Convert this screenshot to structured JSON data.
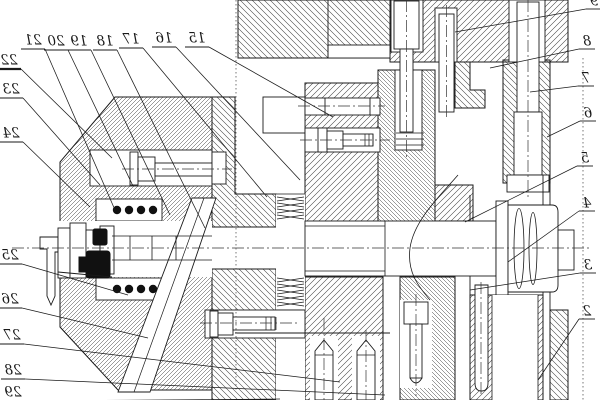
{
  "figure": {
    "type": "mechanical-section-drawing",
    "mirrored_text": true,
    "visible_numbers": [
      "2",
      "3",
      "4",
      "5",
      "6",
      "7",
      "8",
      "9",
      "15",
      "16",
      "17",
      "18",
      "19",
      "20",
      "21",
      "22",
      "23",
      "24",
      "25",
      "26",
      "27",
      "28",
      "29"
    ]
  },
  "colors": {
    "background": "#ffffff",
    "line": "#1a1a1a",
    "hatch": "#404040",
    "seal_fill": "#111111"
  },
  "callouts": [
    {
      "n": "15",
      "x": 197,
      "y": 39,
      "tx": 333,
      "ty": 117,
      "side": "top"
    },
    {
      "n": "16",
      "x": 164,
      "y": 39,
      "tx": 300,
      "ty": 180,
      "side": "top"
    },
    {
      "n": "17",
      "x": 131,
      "y": 40,
      "tx": 267,
      "ty": 197,
      "side": "top"
    },
    {
      "n": "18",
      "x": 105,
      "y": 42,
      "tx": 205,
      "ty": 228,
      "side": "top"
    },
    {
      "n": "19",
      "x": 79,
      "y": 42,
      "tx": 170,
      "ty": 215,
      "side": "top"
    },
    {
      "n": "20",
      "x": 56,
      "y": 42,
      "tx": 133,
      "ty": 186,
      "side": "top"
    },
    {
      "n": "21",
      "x": 33,
      "y": 41,
      "tx": 115,
      "ty": 210,
      "side": "top"
    },
    {
      "n": "22",
      "x": 9,
      "y": 61,
      "tx": 112,
      "ty": 158,
      "side": "left",
      "double_underline": true
    },
    {
      "n": "23",
      "x": 11,
      "y": 90,
      "tx": 100,
      "ty": 185,
      "side": "left"
    },
    {
      "n": "24",
      "x": 11,
      "y": 134,
      "tx": 90,
      "ty": 207,
      "side": "left"
    },
    {
      "n": "25",
      "x": 10,
      "y": 256,
      "tx": 128,
      "ty": 295,
      "side": "left"
    },
    {
      "n": "26",
      "x": 10,
      "y": 300,
      "tx": 148,
      "ty": 338,
      "side": "left"
    },
    {
      "n": "27",
      "x": 12,
      "y": 336,
      "tx": 340,
      "ty": 382,
      "side": "left"
    },
    {
      "n": "28",
      "x": 13,
      "y": 371,
      "tx": 385,
      "ty": 395,
      "side": "left"
    },
    {
      "n": "29",
      "x": 13,
      "y": 393,
      "tx": 280,
      "ty": 399,
      "side": "left"
    },
    {
      "n": "9",
      "x": 594,
      "y": 2,
      "tx": 455,
      "ty": 32,
      "side": "right"
    },
    {
      "n": "8",
      "x": 587,
      "y": 42,
      "tx": 490,
      "ty": 68,
      "side": "right"
    },
    {
      "n": "7",
      "x": 586,
      "y": 79,
      "tx": 530,
      "ty": 92,
      "side": "right"
    },
    {
      "n": "6",
      "x": 588,
      "y": 114,
      "tx": 547,
      "ty": 137,
      "side": "right"
    },
    {
      "n": "5",
      "x": 585,
      "y": 159,
      "tx": 465,
      "ty": 222,
      "side": "right"
    },
    {
      "n": "4",
      "x": 587,
      "y": 204,
      "tx": 508,
      "ty": 262,
      "side": "right"
    },
    {
      "n": "3",
      "x": 588,
      "y": 266,
      "tx": 470,
      "ty": 290,
      "side": "right"
    },
    {
      "n": "2",
      "x": 587,
      "y": 312,
      "tx": 538,
      "ty": 380,
      "side": "right"
    }
  ]
}
